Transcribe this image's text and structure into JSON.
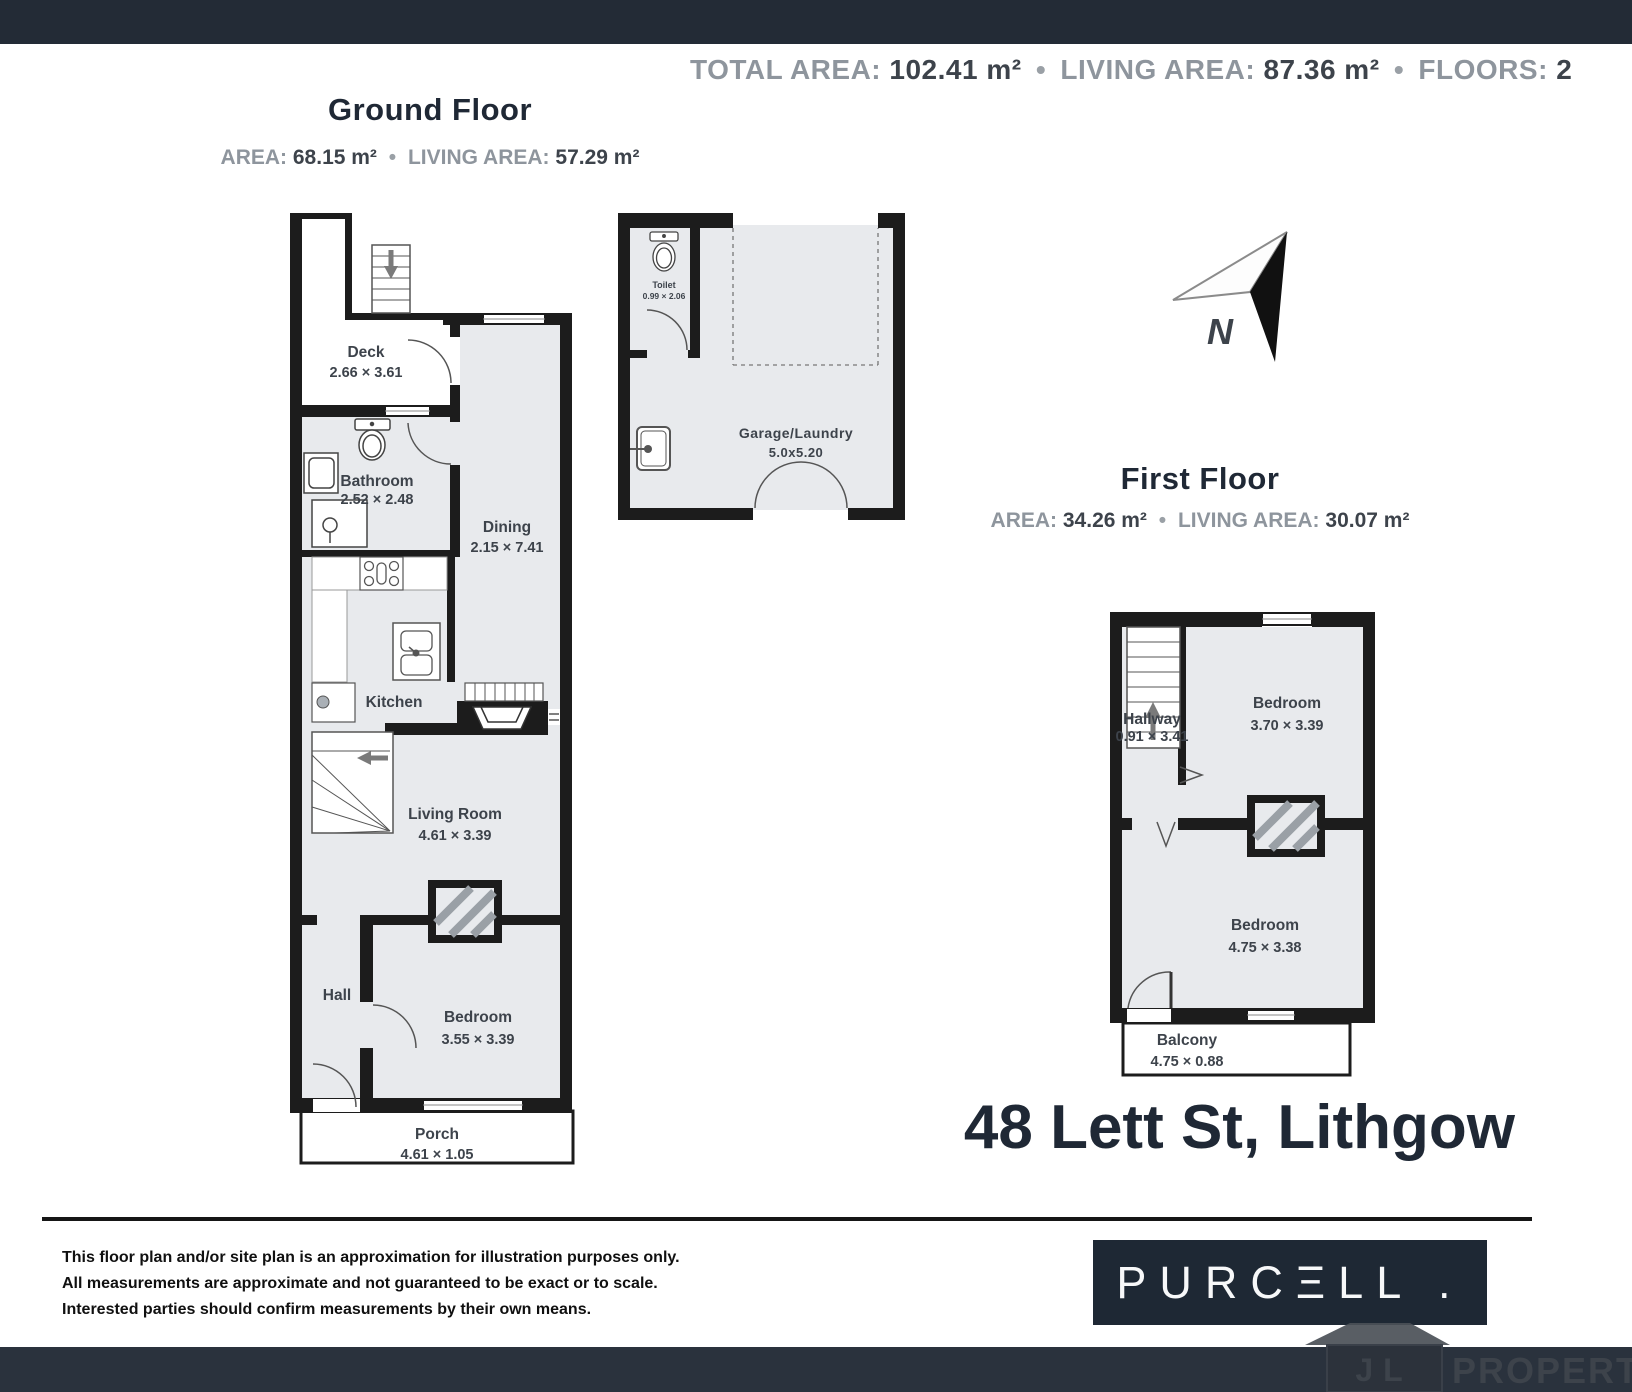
{
  "top_summary": {
    "total_area_label": "TOTAL AREA:",
    "total_area_value": "102.41 m²",
    "living_area_label": "LIVING AREA:",
    "living_area_value": "87.36 m²",
    "floors_label": "FLOORS:",
    "floors_value": "2",
    "separator": "•"
  },
  "ground_floor": {
    "title": "Ground Floor",
    "area_label": "AREA:",
    "area_value": "68.15 m²",
    "living_area_label": "LIVING AREA:",
    "living_area_value": "57.29 m²",
    "rooms": {
      "deck": {
        "name": "Deck",
        "dims": "2.66 × 3.61"
      },
      "bathroom": {
        "name": "Bathroom",
        "dims": "2.52 × 2.48"
      },
      "dining": {
        "name": "Dining",
        "dims": "2.15 × 7.41"
      },
      "kitchen": {
        "name": "Kitchen"
      },
      "living_room": {
        "name": "Living Room",
        "dims": "4.61 × 3.39"
      },
      "hall": {
        "name": "Hall"
      },
      "bedroom": {
        "name": "Bedroom",
        "dims": "3.55 × 3.39"
      },
      "porch": {
        "name": "Porch",
        "dims": "4.61 × 1.05"
      }
    }
  },
  "garage": {
    "toilet": {
      "name": "Toilet",
      "dims": "0.99 × 2.06"
    },
    "garage_laundry": {
      "name": "Garage/Laundry",
      "dims": "5.0x5.20"
    }
  },
  "first_floor": {
    "title": "First Floor",
    "area_label": "AREA:",
    "area_value": "34.26 m²",
    "living_area_label": "LIVING AREA:",
    "living_area_value": "30.07 m²",
    "rooms": {
      "hallway": {
        "name": "Hallway",
        "dims": "0.91 × 3.41"
      },
      "bedroom_1": {
        "name": "Bedroom",
        "dims": "3.70 × 3.39"
      },
      "bedroom_2": {
        "name": "Bedroom",
        "dims": "4.75 × 3.38"
      },
      "balcony": {
        "name": "Balcony",
        "dims": "4.75 × 0.88"
      }
    }
  },
  "compass": {
    "label": "N"
  },
  "address": "48 Lett St, Lithgow",
  "disclaimer": {
    "line1": "This floor plan and/or site plan is an approximation for illustration purposes only.",
    "line2": "All measurements are approximate and not guaranteed to be exact or to scale.",
    "line3": "Interested parties should confirm measurements by their own means."
  },
  "branding": {
    "logo_text": "PURCΞLL .",
    "watermark_initials": "JL",
    "watermark_text": "PROPERTY"
  },
  "colors": {
    "top_bar": "#232b36",
    "bottom_bar": "#2a323d",
    "navy": "#1f2835",
    "room_fill": "#e8eaed",
    "wall": "#1c1c1c",
    "label_gray": "#8e959d",
    "value_dark": "#3d434b"
  }
}
